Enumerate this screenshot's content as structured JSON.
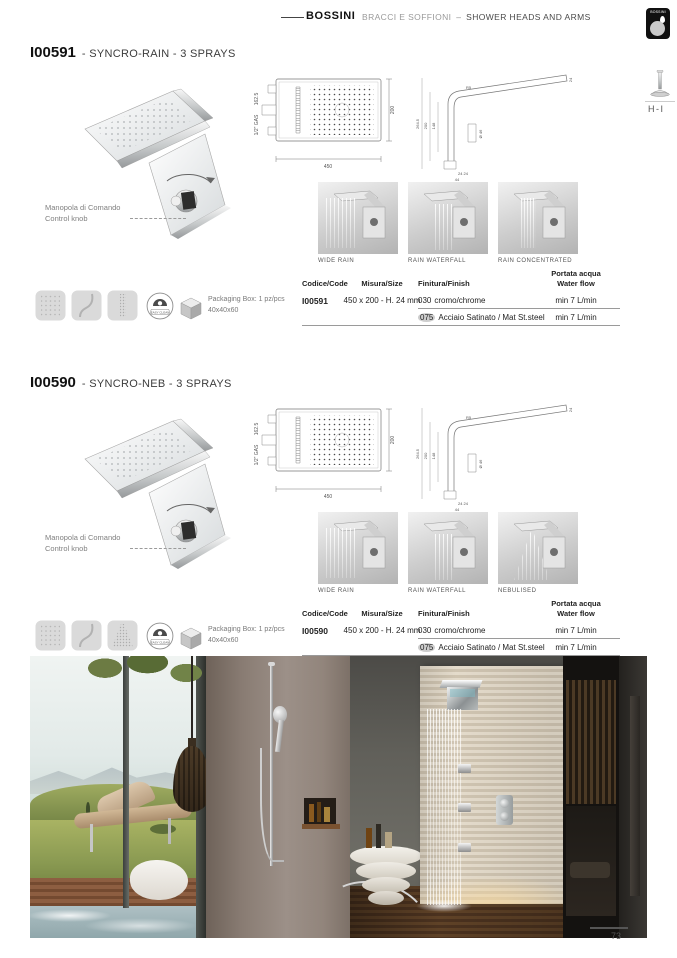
{
  "header": {
    "brand": "BOSSINI",
    "category_it": "BRACCI E SOFFIONI",
    "separator": "–",
    "category_en": "SHOWER HEADS AND ARMS",
    "logo_text": "BOSSINI",
    "tab_label": "H-I"
  },
  "page": {
    "number": "73"
  },
  "shared": {
    "knob_label_it": "Manopola di Comando",
    "knob_label_en": "Control knob",
    "easy_clean_label": "EASY CLEAN",
    "packaging_label": "Packaging Box: 1 pz/pcs",
    "packaging_size": "40x40x60"
  },
  "drawing_front": {
    "thread": "1/2\" GAS",
    "height_left": "162.5",
    "width": "450",
    "depth": "200"
  },
  "drawing_side": {
    "total": "264.5",
    "mid": "200",
    "inner": "148",
    "top": "24",
    "radius": "R5",
    "diameter": "Ø 46",
    "bottom_pair": "24 24",
    "bottom": "44"
  },
  "table_headers": {
    "code": "Codice/Code",
    "size": "Misura/Size",
    "finish": "Finitura/Finish",
    "flow_l1": "Portata acqua",
    "flow_l2": "Water flow"
  },
  "sections": [
    {
      "code": "I00591",
      "suffix": "- SYNCRO-RAIN - 3 SPRAYS",
      "captions": [
        "WIDE RAIN",
        "RAIN WATERFALL",
        "RAIN CONCENTRATED"
      ],
      "rows": [
        {
          "code": "I00591",
          "size": "450 x 200 - H. 24 mm",
          "finish_code": "030",
          "finish_name": "cromo/chrome",
          "flow": "min 7 L/min"
        },
        {
          "finish_code": "075",
          "finish_name": "Acciaio Satinato / Mat St.steel",
          "flow": "min 7 L/min"
        }
      ]
    },
    {
      "code": "I00590",
      "suffix": "- SYNCRO-NEB - 3 SPRAYS",
      "captions": [
        "WIDE RAIN",
        "RAIN WATERFALL",
        "NEBULISED"
      ],
      "rows": [
        {
          "code": "I00590",
          "size": "450 x 200 - H. 24 mm",
          "finish_code": "030",
          "finish_name": "cromo/chrome",
          "flow": "min 7 L/min"
        },
        {
          "finish_code": "075",
          "finish_name": "Acciaio Satinato / Mat St.steel",
          "flow": "min 7 L/min"
        }
      ]
    }
  ]
}
